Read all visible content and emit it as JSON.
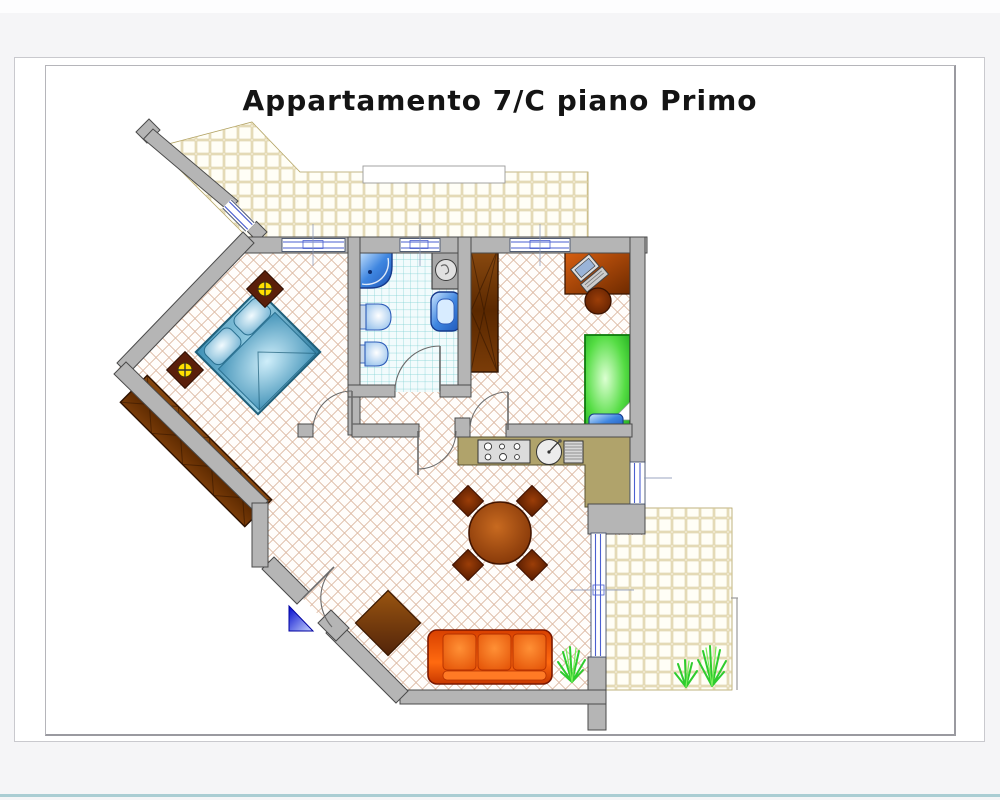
{
  "page": {
    "title": "Appartamento 7/C piano Primo",
    "background": "#f5f5f7",
    "divider_color": "#aacdd3"
  },
  "plan": {
    "colors": {
      "wall": "#b5b5b5",
      "wall_outline": "#4a4a4a",
      "floor_lattice": "#d9b49c",
      "terrace_tile": "#d5c794",
      "bath_tile": "#72cbd0",
      "window_blue": "#4a5fd0",
      "kitchen_counter": "#b0a36b",
      "sofa_orange": "#f05a00",
      "table_brown": "#9c4a10",
      "bed_blue": "#57a8cc",
      "bed_green": "#33cc33",
      "wardrobe_brown": "#6b3508",
      "desk_brown": "#b34700",
      "plant_green": "#2ecc2e",
      "lamp_yellow": "#ffe000",
      "divider": "#aacdd3"
    }
  }
}
